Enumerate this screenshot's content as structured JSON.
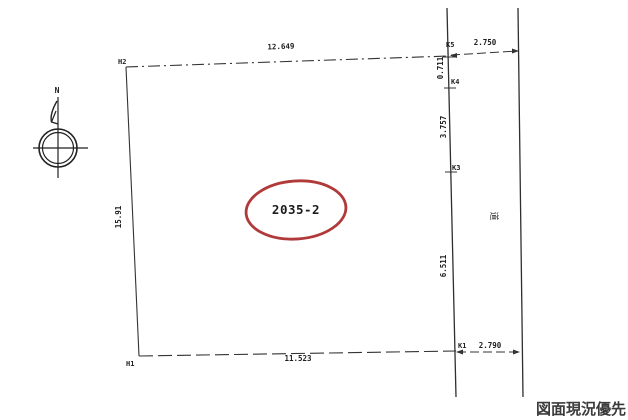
{
  "drawing": {
    "note": "図面現況優先",
    "compass": {
      "north_label": "N"
    },
    "road_label": "道",
    "parcel_label": "2035-2",
    "points": {
      "h2": "H2",
      "h1": "H1",
      "k5": "K5",
      "k4": "K4",
      "k3": "K3",
      "k1": "K1"
    },
    "dims": {
      "top": "12.649",
      "top_road": "2.750",
      "k5_k4": "0.711",
      "k4_k3": "3.757",
      "k3_k1": "6.511",
      "bottom_road": "2.790",
      "bottom": "11.523",
      "left": "15.91"
    },
    "colors": {
      "line": "#3a3a3a",
      "highlight": "#b03a3a",
      "text": "#222222"
    }
  }
}
